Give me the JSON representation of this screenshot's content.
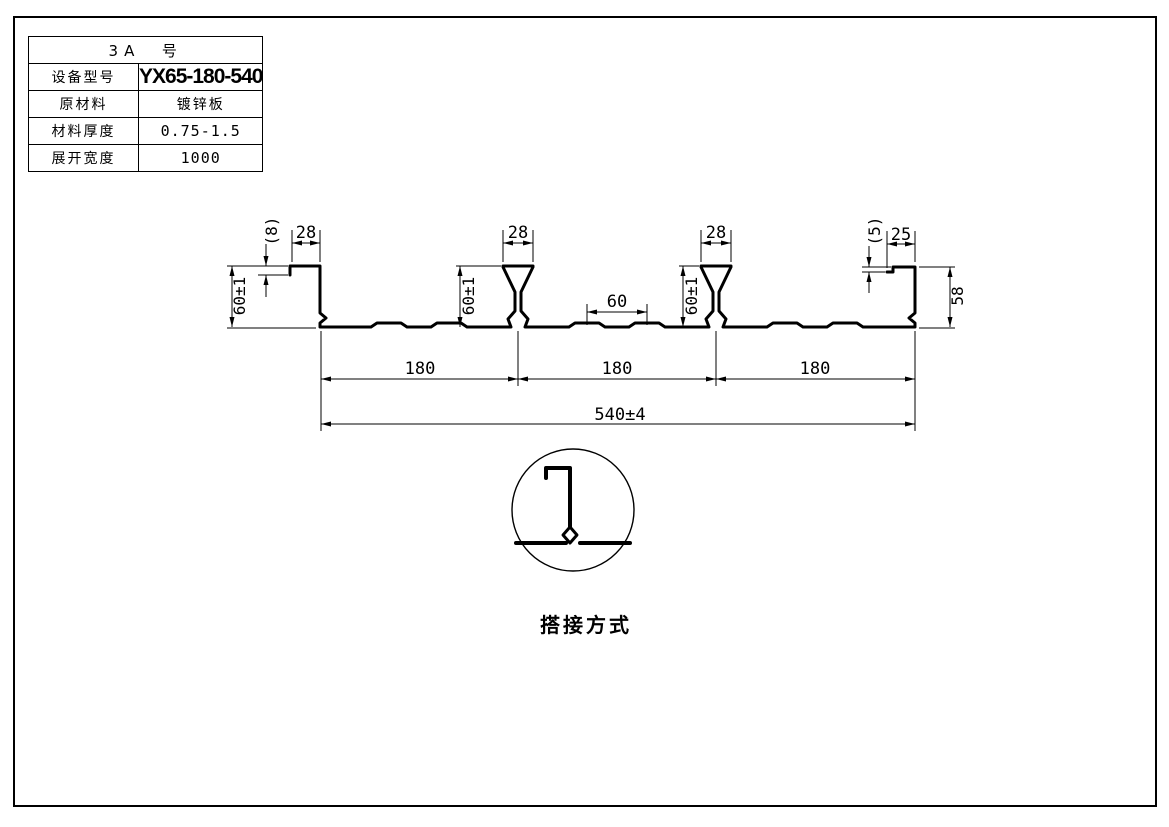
{
  "spec_table": {
    "title": "3A  号",
    "rows": [
      {
        "label": "设备型号",
        "value": "YX65-180-540"
      },
      {
        "label": "原材料",
        "value": "镀锌板"
      },
      {
        "label": "材料厚度",
        "value": "0.75-1.5"
      },
      {
        "label": "展开宽度",
        "value": "1000"
      }
    ]
  },
  "profile": {
    "dims": {
      "left_lip_height": "(8)",
      "left_top_width": "28",
      "left_height": "60±1",
      "rib1_top_width": "28",
      "rib1_height": "60±1",
      "emboss_spacing": "60",
      "rib2_top_width": "28",
      "rib2_height": "60±1",
      "right_lip_height": "(5)",
      "right_top_width": "25",
      "right_height": "58",
      "span1": "180",
      "span2": "180",
      "span3": "180",
      "overall_width": "540±4"
    }
  },
  "detail": {
    "caption": "搭接方式"
  }
}
